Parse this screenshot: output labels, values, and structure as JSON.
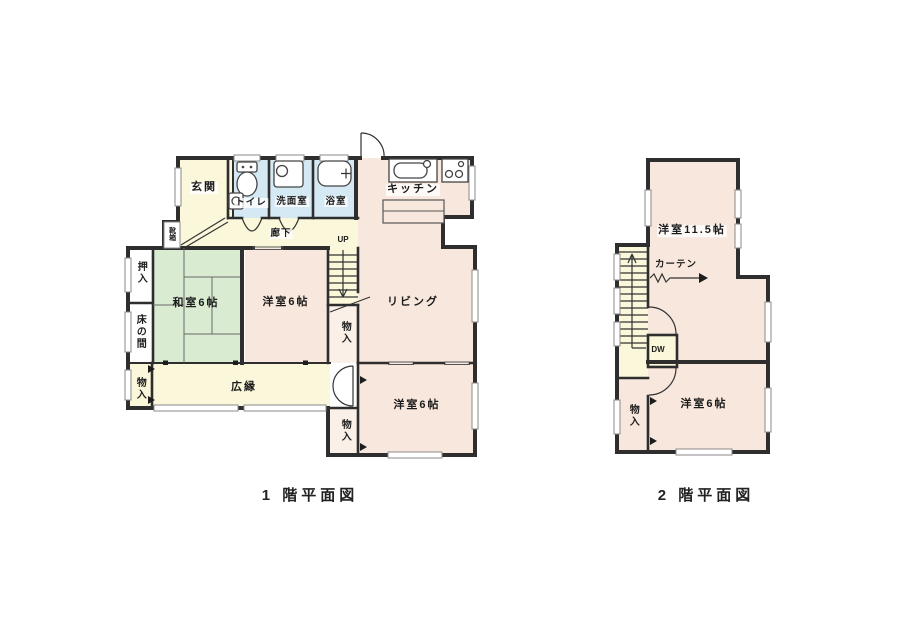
{
  "document": {
    "background": "#ffffff"
  },
  "palette": {
    "room_pink": "#f8e7dd",
    "closet_pink": "#faf0e8",
    "tatami_green": "#d9ebd1",
    "hall_cream": "#fbf7da",
    "wet_blue": "#d4e9f3",
    "plain_white": "#ffffff",
    "wall": "#2e2e2e"
  },
  "floor1": {
    "caption": "1 階平面図",
    "labels": {
      "genkan": "玄関",
      "toilet": "トイレ",
      "washroom": "洗面室",
      "bathroom": "浴室",
      "kitchen": "キッチン",
      "hallway": "廊下",
      "up": "UP",
      "shoebox": "靴箱",
      "oshiire": "押入",
      "tokonoma": "床の間",
      "washitsu": "和室6帖",
      "youshitsu_center": "洋室6帖",
      "living": "リビング",
      "closet_stairs": "物入",
      "hiroen": "広縁",
      "closet_left": "物入",
      "closet_south": "物入",
      "youshitsu_southeast": "洋室6帖"
    }
  },
  "floor2": {
    "caption": "2 階平面図",
    "labels": {
      "main_room": "洋室11.5帖",
      "curtain": "カーテン",
      "dw": "DW",
      "closet": "物入",
      "youshitsu": "洋室6帖"
    }
  }
}
